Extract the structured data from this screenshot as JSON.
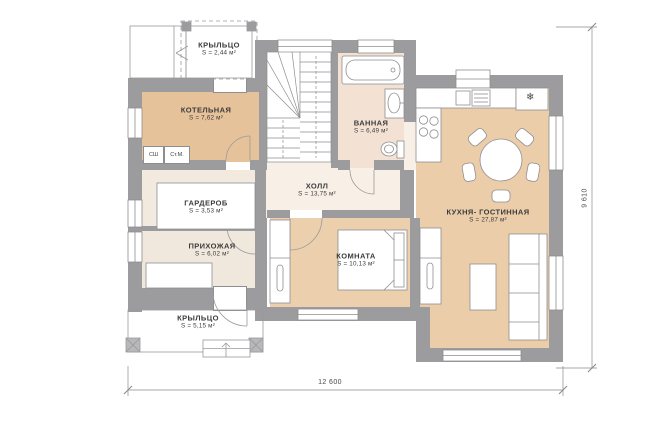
{
  "plan": {
    "rooms": [
      {
        "name": "КРЫЛЬЦО",
        "area": "S = 2,44 м²"
      },
      {
        "name": "КОТЕЛЬНАЯ",
        "area": "S = 7,62 м²"
      },
      {
        "name": "ВАННАЯ",
        "area": "S = 6,49 м²"
      },
      {
        "name": "ХОЛЛ",
        "area": "S = 13,75 м²"
      },
      {
        "name": "ГАРДЕРОБ",
        "area": "S = 3,53 м²"
      },
      {
        "name": "ПРИХОЖАЯ",
        "area": "S = 6,02 м²"
      },
      {
        "name": "КОМНАТА",
        "area": "S = 10,13 м²"
      },
      {
        "name": "КУХНЯ- ГОСТИННАЯ",
        "area": "S = 27,87 м²"
      },
      {
        "name": "КРЫЛЬЦО",
        "area": "S = 5,15 м²"
      }
    ],
    "closets": [
      {
        "label": "СШ"
      },
      {
        "label": "Ст.М."
      }
    ],
    "dimensions": {
      "bottom": "12 600",
      "right": "9 610"
    },
    "icons": {
      "fridge": "❄"
    },
    "colors": {
      "wall": "#9c9c9e",
      "room_tan": "#e8c49c",
      "room_cream": "#f6ece2",
      "room_pink": "#f3e2d4",
      "linework": "#8e8e90"
    }
  }
}
